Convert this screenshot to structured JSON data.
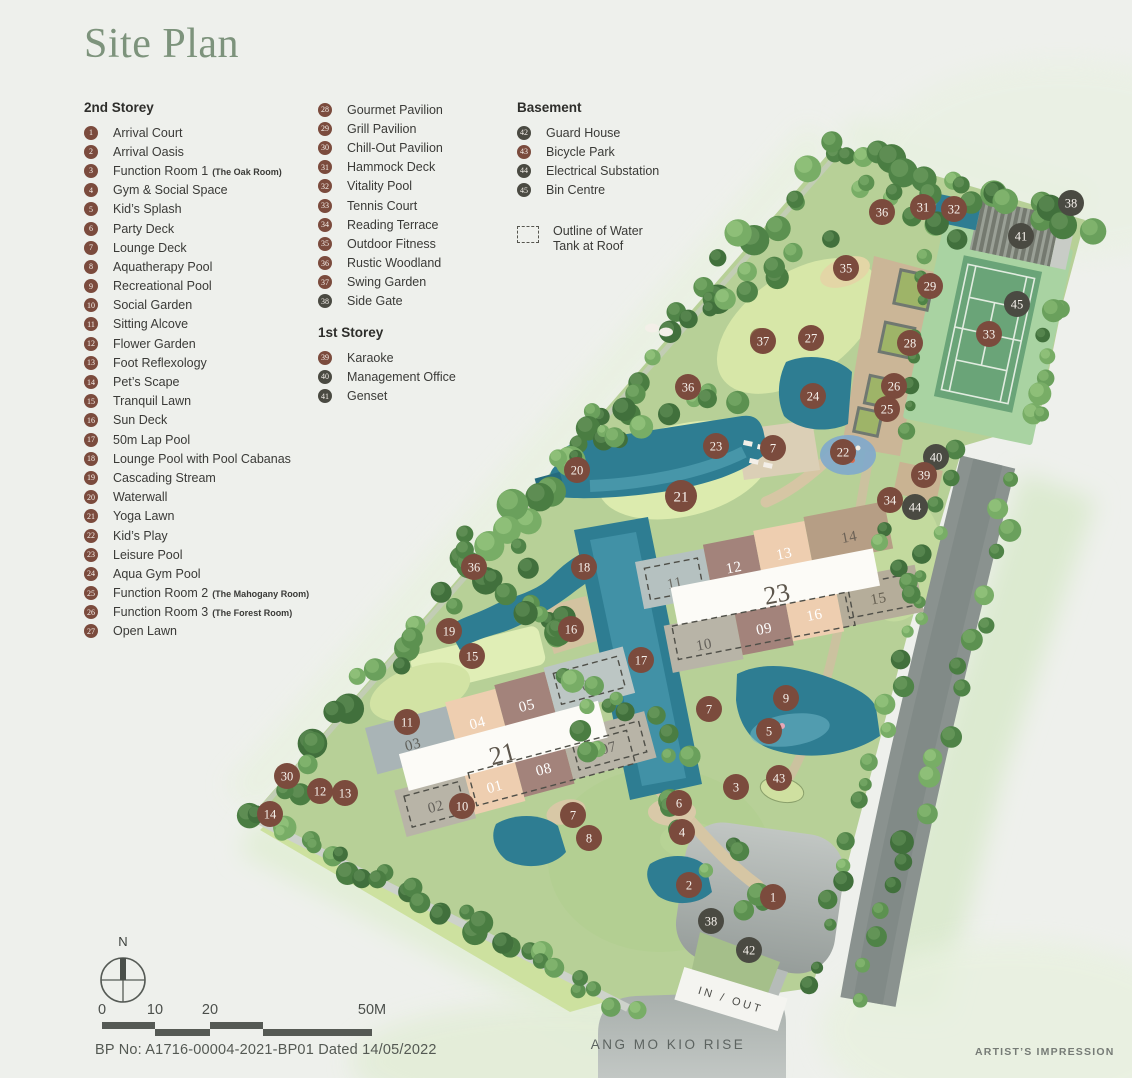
{
  "page_title": "Site Plan",
  "colors": {
    "accent_brown": "#7b4b3d",
    "accent_dark": "#4a4a42",
    "title_green": "#7d937c",
    "pool_teal": "#2e7d92"
  },
  "legend": {
    "col1": {
      "heading": "2nd Storey",
      "items": [
        {
          "n": "1",
          "label": "Arrival Court"
        },
        {
          "n": "2",
          "label": "Arrival Oasis"
        },
        {
          "n": "3",
          "label": "Function Room 1",
          "suffix": "(The Oak Room)"
        },
        {
          "n": "4",
          "label": "Gym & Social Space"
        },
        {
          "n": "5",
          "label": "Kid’s Splash"
        },
        {
          "n": "6",
          "label": "Party Deck"
        },
        {
          "n": "7",
          "label": "Lounge Deck"
        },
        {
          "n": "8",
          "label": "Aquatherapy Pool"
        },
        {
          "n": "9",
          "label": "Recreational Pool"
        },
        {
          "n": "10",
          "label": "Social Garden"
        },
        {
          "n": "11",
          "label": "Sitting Alcove"
        },
        {
          "n": "12",
          "label": "Flower Garden"
        },
        {
          "n": "13",
          "label": "Foot Reflexology"
        },
        {
          "n": "14",
          "label": "Pet’s Scape"
        },
        {
          "n": "15",
          "label": "Tranquil Lawn"
        },
        {
          "n": "16",
          "label": "Sun Deck"
        },
        {
          "n": "17",
          "label": "50m Lap Pool"
        },
        {
          "n": "18",
          "label": "Lounge Pool with Pool Cabanas"
        },
        {
          "n": "19",
          "label": "Cascading Stream"
        },
        {
          "n": "20",
          "label": "Waterwall"
        },
        {
          "n": "21",
          "label": "Yoga Lawn"
        },
        {
          "n": "22",
          "label": "Kid’s Play"
        },
        {
          "n": "23",
          "label": "Leisure Pool"
        },
        {
          "n": "24",
          "label": "Aqua Gym Pool"
        },
        {
          "n": "25",
          "label": "Function Room 2",
          "suffix": "(The Mahogany Room)"
        },
        {
          "n": "26",
          "label": "Function Room 3",
          "suffix": "(The Forest Room)"
        },
        {
          "n": "27",
          "label": "Open Lawn"
        }
      ]
    },
    "col2a": {
      "items": [
        {
          "n": "28",
          "label": "Gourmet Pavilion"
        },
        {
          "n": "29",
          "label": "Grill Pavilion"
        },
        {
          "n": "30",
          "label": "Chill-Out Pavilion"
        },
        {
          "n": "31",
          "label": "Hammock Deck"
        },
        {
          "n": "32",
          "label": "Vitality Pool"
        },
        {
          "n": "33",
          "label": "Tennis Court"
        },
        {
          "n": "34",
          "label": "Reading Terrace"
        },
        {
          "n": "35",
          "label": "Outdoor Fitness"
        },
        {
          "n": "36",
          "label": "Rustic Woodland"
        },
        {
          "n": "37",
          "label": "Swing Garden"
        },
        {
          "n": "38",
          "label": "Side Gate",
          "shade": "dark"
        }
      ]
    },
    "col2b": {
      "heading": "1st Storey",
      "items": [
        {
          "n": "39",
          "label": "Karaoke"
        },
        {
          "n": "40",
          "label": "Management Office",
          "shade": "dark"
        },
        {
          "n": "41",
          "label": "Genset",
          "shade": "dark"
        }
      ]
    },
    "col3": {
      "heading": "Basement",
      "items": [
        {
          "n": "42",
          "label": "Guard House",
          "shade": "dark"
        },
        {
          "n": "43",
          "label": "Bicycle Park"
        },
        {
          "n": "44",
          "label": "Electrical Substation",
          "shade": "dark"
        },
        {
          "n": "45",
          "label": "Bin Centre",
          "shade": "dark"
        }
      ]
    },
    "note": {
      "line1": "Outline of Water",
      "line2": "Tank at Roof"
    }
  },
  "map": {
    "road_label": "ANG MO KIO RISE",
    "gate_label": "IN / OUT",
    "markers": [
      {
        "n": "36",
        "x": 882,
        "y": 212
      },
      {
        "n": "31",
        "x": 923,
        "y": 207
      },
      {
        "n": "32",
        "x": 954,
        "y": 209
      },
      {
        "n": "38",
        "x": 1071,
        "y": 203,
        "s": "d"
      },
      {
        "n": "41",
        "x": 1021,
        "y": 236,
        "s": "d"
      },
      {
        "n": "35",
        "x": 846,
        "y": 268
      },
      {
        "n": "29",
        "x": 930,
        "y": 286
      },
      {
        "n": "45",
        "x": 1017,
        "y": 304,
        "s": "d"
      },
      {
        "n": "33",
        "x": 989,
        "y": 334
      },
      {
        "n": "37",
        "x": 763,
        "y": 341
      },
      {
        "n": "27",
        "x": 811,
        "y": 338
      },
      {
        "n": "28",
        "x": 910,
        "y": 343
      },
      {
        "n": "26",
        "x": 894,
        "y": 386
      },
      {
        "n": "25",
        "x": 887,
        "y": 409
      },
      {
        "n": "24",
        "x": 813,
        "y": 396
      },
      {
        "n": "36",
        "x": 688,
        "y": 387
      },
      {
        "n": "23",
        "x": 716,
        "y": 446
      },
      {
        "n": "7",
        "x": 773,
        "y": 448
      },
      {
        "n": "22",
        "x": 843,
        "y": 452
      },
      {
        "n": "40",
        "x": 936,
        "y": 457,
        "s": "d"
      },
      {
        "n": "20",
        "x": 577,
        "y": 470
      },
      {
        "n": "39",
        "x": 924,
        "y": 475
      },
      {
        "n": "21",
        "x": 681,
        "y": 496,
        "r": 16
      },
      {
        "n": "34",
        "x": 890,
        "y": 500
      },
      {
        "n": "44",
        "x": 915,
        "y": 507,
        "s": "d"
      },
      {
        "n": "36",
        "x": 474,
        "y": 567
      },
      {
        "n": "18",
        "x": 584,
        "y": 567
      },
      {
        "n": "16",
        "x": 571,
        "y": 629
      },
      {
        "n": "19",
        "x": 449,
        "y": 631
      },
      {
        "n": "15",
        "x": 472,
        "y": 656
      },
      {
        "n": "17",
        "x": 641,
        "y": 660
      },
      {
        "n": "9",
        "x": 786,
        "y": 698
      },
      {
        "n": "7",
        "x": 709,
        "y": 709
      },
      {
        "n": "11",
        "x": 407,
        "y": 722
      },
      {
        "n": "5",
        "x": 769,
        "y": 731
      },
      {
        "n": "30",
        "x": 287,
        "y": 776
      },
      {
        "n": "43",
        "x": 779,
        "y": 778
      },
      {
        "n": "12",
        "x": 320,
        "y": 791
      },
      {
        "n": "13",
        "x": 345,
        "y": 793
      },
      {
        "n": "3",
        "x": 736,
        "y": 787
      },
      {
        "n": "6",
        "x": 679,
        "y": 803
      },
      {
        "n": "10",
        "x": 462,
        "y": 806
      },
      {
        "n": "14",
        "x": 270,
        "y": 814
      },
      {
        "n": "7",
        "x": 573,
        "y": 815
      },
      {
        "n": "4",
        "x": 682,
        "y": 832
      },
      {
        "n": "8",
        "x": 589,
        "y": 838
      },
      {
        "n": "2",
        "x": 689,
        "y": 885
      },
      {
        "n": "1",
        "x": 773,
        "y": 897
      },
      {
        "n": "38",
        "x": 711,
        "y": 921,
        "s": "d"
      },
      {
        "n": "42",
        "x": 749,
        "y": 950,
        "s": "d"
      }
    ],
    "blocks": [
      {
        "label": "21",
        "stacks": [
          "03",
          "04",
          "05",
          "06",
          "02",
          "01",
          "08",
          "07"
        ]
      },
      {
        "label": "23",
        "stacks": [
          "11",
          "12",
          "13",
          "14",
          "10",
          "09",
          "16",
          "15"
        ]
      }
    ]
  },
  "footer": {
    "north": "N",
    "scale_labels": [
      "0",
      "10",
      "20",
      "50M"
    ],
    "bp": "BP No: A1716-00004-2021-BP01 Dated 14/05/2022",
    "impression": "ARTIST’S IMPRESSION"
  }
}
